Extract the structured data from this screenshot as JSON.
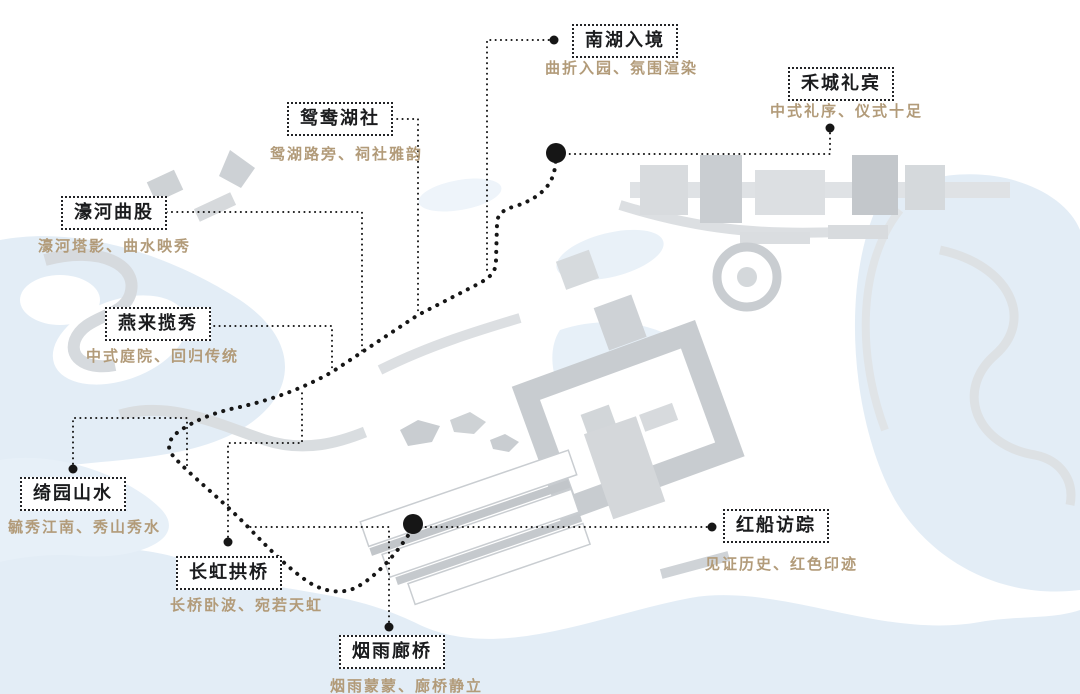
{
  "title": "园区游览动线示意图",
  "colors": {
    "label_text": "#1b1c1e",
    "subtitle_text": "#b29b79",
    "line": "#161616",
    "water": "#e3edf6",
    "building_light": "#d9dcdf",
    "building_mid": "#c8ccd0",
    "building_dark": "#c3c7cb"
  },
  "labels": [
    {
      "id": "nanhu",
      "title": "南湖入境",
      "subtitle": "曲折入园、氛围渲染"
    },
    {
      "id": "hecheng",
      "title": "禾城礼宾",
      "subtitle": "中式礼序、仪式十足"
    },
    {
      "id": "yuanyang",
      "title": "鸳鸯湖社",
      "subtitle": "鸳湖路旁、祠社雅韵"
    },
    {
      "id": "haohe",
      "title": "濠河曲股",
      "subtitle": "濠河塔影、曲水映秀"
    },
    {
      "id": "yanlai",
      "title": "燕来揽秀",
      "subtitle": "中式庭院、回归传统"
    },
    {
      "id": "qiyuan",
      "title": "绮园山水",
      "subtitle": "毓秀江南、秀山秀水"
    },
    {
      "id": "changhong",
      "title": "长虹拱桥",
      "subtitle": "长桥卧波、宛若天虹"
    },
    {
      "id": "yanyu",
      "title": "烟雨廊桥",
      "subtitle": "烟雨蒙蒙、廊桥静立"
    },
    {
      "id": "hongchuan",
      "title": "红船访踪",
      "subtitle": "见证历史、红色印迹"
    }
  ]
}
